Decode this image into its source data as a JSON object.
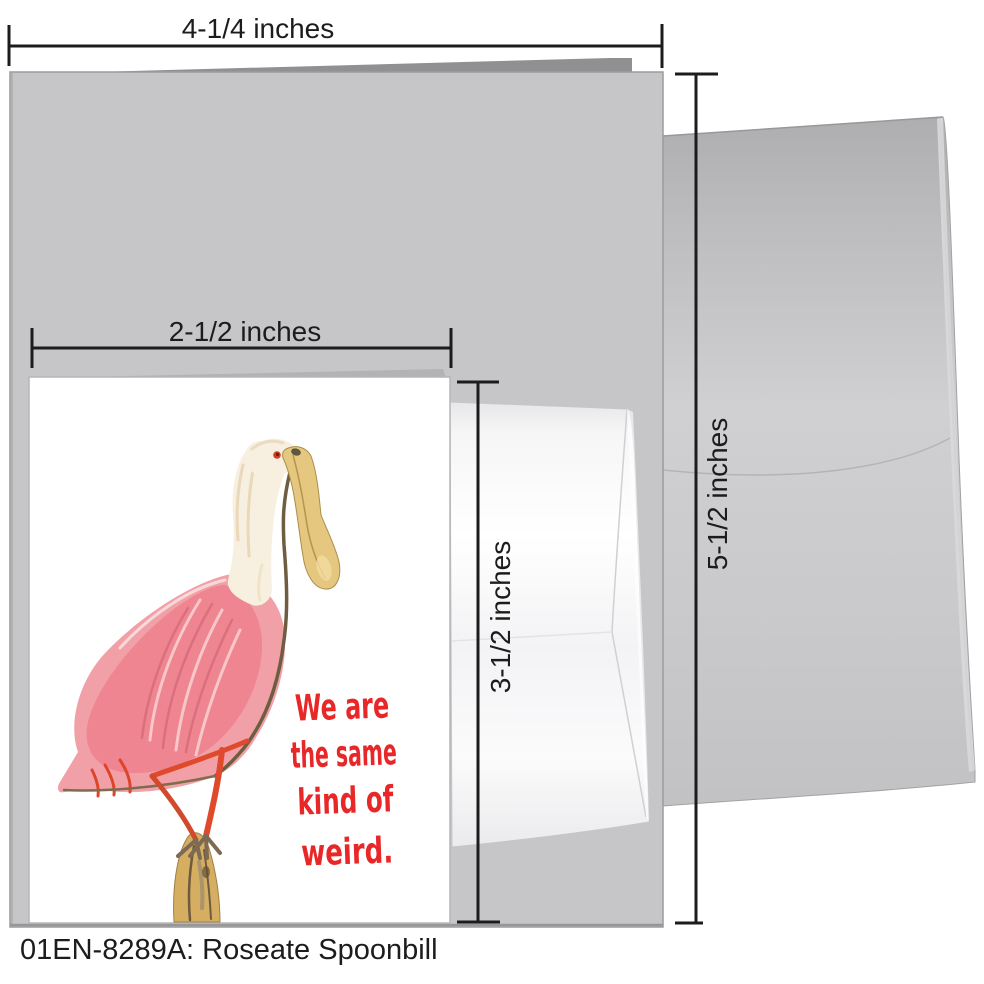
{
  "product": {
    "caption": "01EN-8289A: Roseate Spoonbill",
    "message_lines": [
      "We are",
      "the same",
      "kind of",
      "weird."
    ]
  },
  "dimensions": {
    "large_card_width": "4-1/4 inches",
    "large_card_height": "5-1/2 inches",
    "small_card_width": "2-1/2 inches",
    "small_card_height": "3-1/2 inches"
  },
  "colors": {
    "message_red": "#e82728",
    "annotation_black": "#1c1c1c",
    "large_card_gray": "#c6c6c8",
    "card_fold_gray": "#909092",
    "envelope_gray": "#c4c4c6",
    "small_card_white": "#ffffff",
    "body_pink": "#f2a0a8",
    "wing_pink": "#ee8590",
    "bill_tan": "#e6c77f",
    "leg_red": "#e04a2c",
    "branch_tan": "#d6ae62",
    "neck_cream": "#f7efdf"
  }
}
